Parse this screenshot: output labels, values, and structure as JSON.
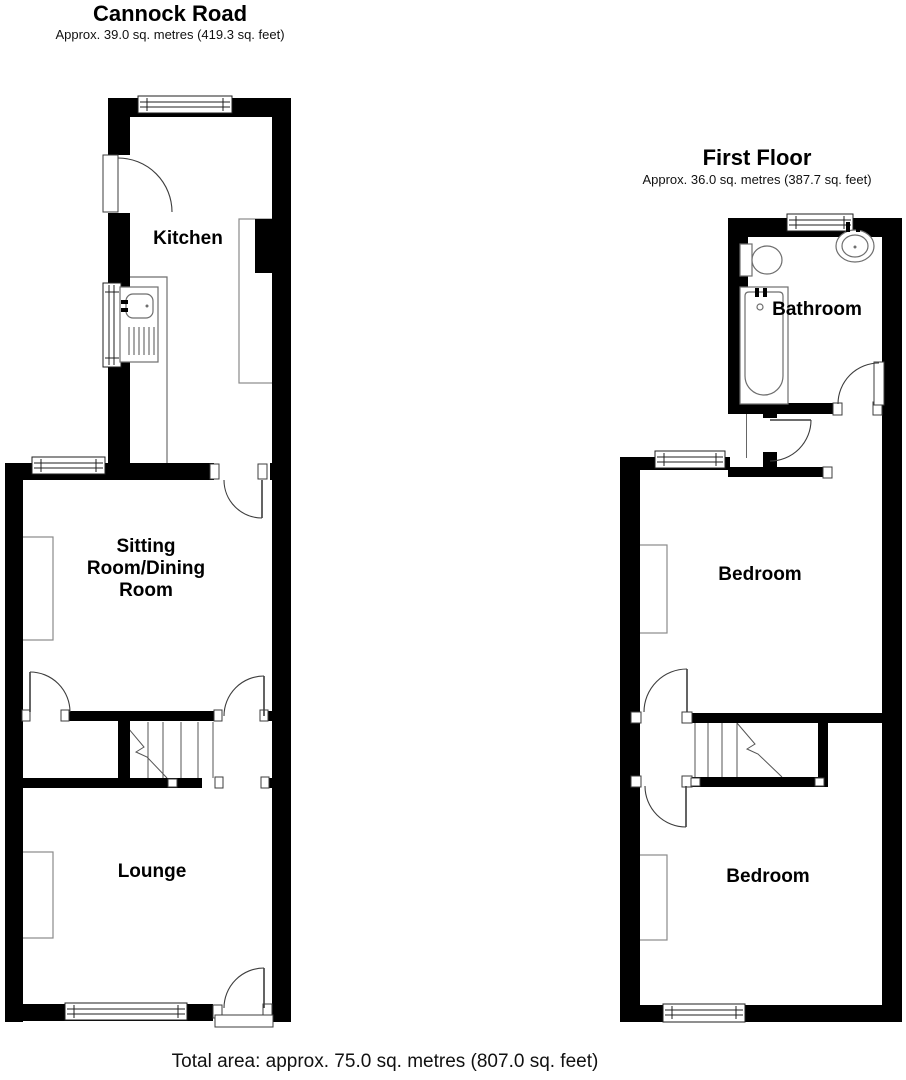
{
  "ground_floor": {
    "title": "Cannock Road",
    "area_note": "Approx. 39.0 sq. metres (419.3 sq. feet)",
    "rooms": {
      "kitchen": {
        "label": "Kitchen"
      },
      "sitting_room": {
        "label_lines": [
          "Sitting",
          "Room/Dining",
          "Room"
        ]
      },
      "lounge": {
        "label": "Lounge"
      }
    },
    "fixtures": [
      "kitchen-sink",
      "worktop",
      "chimney-breast",
      "staircase",
      "window",
      "door"
    ]
  },
  "first_floor": {
    "title": "First Floor",
    "area_note": "Approx. 36.0 sq. metres (387.7 sq. feet)",
    "rooms": {
      "bathroom": {
        "label": "Bathroom"
      },
      "bedroom_front": {
        "label": "Bedroom"
      },
      "bedroom_back": {
        "label": "Bedroom"
      }
    },
    "fixtures": [
      "bath",
      "toilet",
      "wash-basin",
      "staircase",
      "window",
      "door"
    ]
  },
  "footer": {
    "total_area": "Total area: approx. 75.0 sq. metres (807.0 sq. feet)"
  },
  "colors": {
    "wall": "#000000",
    "floor": "#ffffff",
    "fixture_outline": "#8a8a8a",
    "text": "#1a1a1a"
  }
}
